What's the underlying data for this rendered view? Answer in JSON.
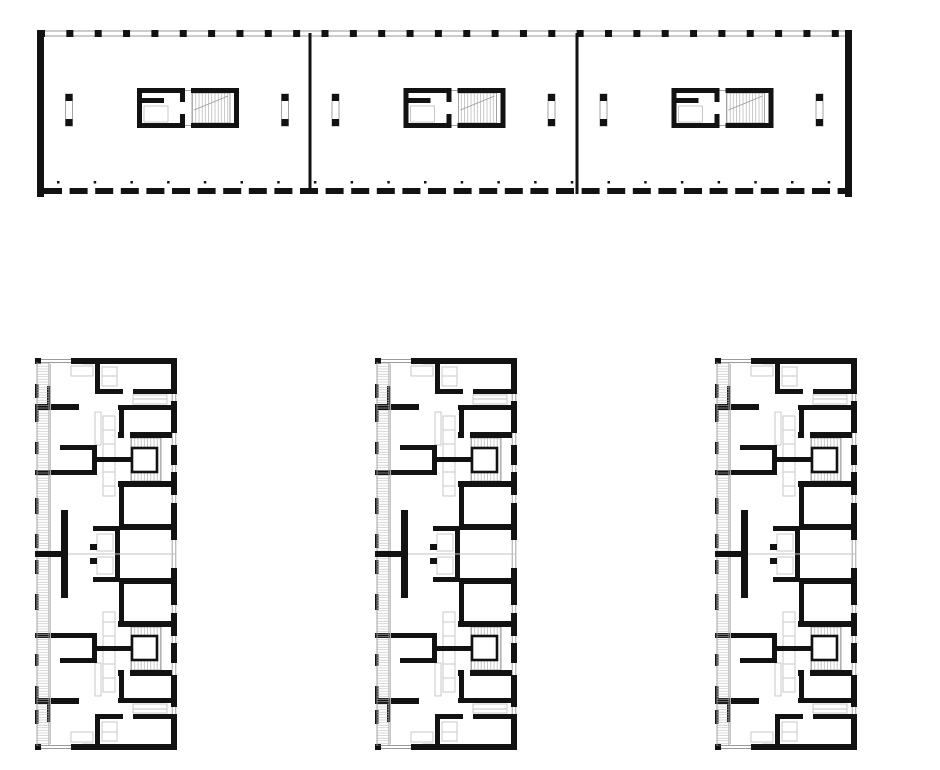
{
  "meta": {
    "description": "Black-and-white architectural floor plan drawing: one long ground-floor slab plan on top (three bays, each with an elevator and stair core and two flanking columns) and three identical tall residential floor plans below (apartments with left balcony band, stair cores with elevators, rooms with window openings).",
    "canvas_w": 940,
    "canvas_h": 770,
    "background": "#ffffff"
  },
  "colors": {
    "wall": "#121212",
    "thin": "#9a9a9a",
    "lite": "#c3c3c3",
    "hatch_h": "#bdbdbd",
    "hatch_v": "#a5a5a5",
    "paper": "#ffffff"
  },
  "figures": {
    "ground_plan": {
      "x": 0,
      "y": 0,
      "bay_centers": [
        177,
        443.5,
        711.5
      ],
      "full": [
        [
          "l",
          37,
          31,
          852,
          31,
          "thin"
        ],
        [
          "l",
          37,
          36,
          852,
          36,
          "thin"
        ],
        [
          "tk",
          38,
          30,
          29,
          28.35,
          7,
          7
        ],
        [
          "r",
          845,
          30,
          7,
          7,
          "wall"
        ],
        [
          "r",
          37,
          30,
          7,
          167,
          "wall"
        ],
        [
          "r",
          845,
          30,
          7,
          167,
          "wall"
        ],
        [
          "r",
          308.5,
          33,
          3,
          161,
          "wall"
        ],
        [
          "r",
          575.5,
          33,
          3,
          161,
          "wall"
        ],
        [
          "dl",
          44,
          188,
          801,
          18,
          7.6,
          6
        ],
        [
          "tk",
          57,
          181,
          22,
          36.7,
          2.5,
          2.5
        ]
      ],
      "bay": [
        [
          "o",
          -111.5,
          94,
          7,
          32,
          "thin"
        ],
        [
          "o",
          104.5,
          94,
          7,
          32,
          "thin"
        ],
        [
          "o",
          -33,
          106,
          24,
          16,
          "lite"
        ],
        [
          "l",
          8,
          90.5,
          14,
          90.5,
          "thin"
        ],
        [
          "l",
          8,
          125.5,
          14,
          125.5,
          "thin"
        ],
        [
          "vv",
          15,
          93,
          38,
          30
        ],
        [
          "o",
          15,
          93,
          38,
          30,
          "thin"
        ],
        [
          "l",
          17,
          110,
          51,
          96,
          "thin"
        ],
        [
          "r",
          -111.5,
          94,
          7,
          7,
          "wall"
        ],
        [
          "r",
          -111.5,
          119,
          7,
          7,
          "wall"
        ],
        [
          "r",
          104.5,
          94,
          7,
          7,
          "wall"
        ],
        [
          "r",
          104.5,
          119,
          7,
          7,
          "wall"
        ],
        [
          "r",
          -40,
          88,
          48,
          5,
          "wall"
        ],
        [
          "r",
          14,
          88,
          48,
          5,
          "wall"
        ],
        [
          "r",
          -40,
          123,
          48,
          5,
          "wall"
        ],
        [
          "r",
          14,
          123,
          48,
          5,
          "wall"
        ],
        [
          "r",
          -40,
          88,
          5,
          40,
          "wall"
        ],
        [
          "r",
          3,
          88,
          5,
          14,
          "wall"
        ],
        [
          "r",
          3,
          114,
          5,
          14,
          "wall"
        ],
        [
          "r",
          -35,
          98,
          22,
          5,
          "wall"
        ],
        [
          "r",
          57,
          88,
          5,
          40,
          "wall"
        ]
      ]
    },
    "tower_plan": {
      "y": 358,
      "w": 142,
      "h": 392,
      "half_h": 196,
      "x_positions": [
        35,
        375,
        715
      ],
      "full": [
        [
          "hh",
          2,
          4,
          12,
          384
        ],
        [
          "l",
          2,
          4,
          2,
          388,
          "thin"
        ],
        [
          "l",
          14,
          4,
          14,
          388,
          "thin"
        ],
        [
          "l",
          15.5,
          6,
          15.5,
          386,
          "lite"
        ],
        [
          "l",
          2,
          196,
          140,
          196,
          "lite"
        ],
        [
          "r",
          26,
          152,
          7,
          88,
          "wall"
        ],
        [
          "r",
          0,
          193,
          33,
          6,
          "wall"
        ]
      ],
      "half": [
        [
          "l",
          6,
          1.5,
          36,
          1.5,
          "thin"
        ],
        [
          "l",
          6,
          4.5,
          36,
          4.5,
          "thin"
        ],
        [
          "o",
          67,
          9,
          15,
          19,
          "lite"
        ],
        [
          "l",
          67,
          18,
          82,
          18,
          "lite"
        ],
        [
          "o",
          36,
          8,
          22,
          10,
          "lite"
        ],
        [
          "o",
          48,
          2,
          10,
          4,
          "lite"
        ],
        [
          "o",
          98,
          37,
          34,
          9,
          "lite"
        ],
        [
          "l",
          98,
          41,
          132,
          41,
          "lite"
        ],
        [
          "o",
          68,
          58,
          12,
          80,
          "lite"
        ],
        [
          "l",
          68,
          72,
          80,
          72,
          "lite"
        ],
        [
          "l",
          68,
          86,
          80,
          86,
          "lite"
        ],
        [
          "l",
          68,
          100,
          80,
          100,
          "lite"
        ],
        [
          "l",
          68,
          114,
          80,
          114,
          "lite"
        ],
        [
          "l",
          68,
          128,
          80,
          128,
          "lite"
        ],
        [
          "o",
          60,
          54,
          6,
          33,
          "lite"
        ],
        [
          "o",
          62,
          176,
          16,
          17,
          "lite"
        ],
        [
          "l",
          137.2,
          35,
          137.2,
          43,
          "thin"
        ],
        [
          "l",
          140.8,
          35,
          140.8,
          43,
          "thin"
        ],
        [
          "l",
          137.2,
          75,
          137.2,
          87,
          "thin"
        ],
        [
          "l",
          140.8,
          75,
          140.8,
          87,
          "thin"
        ],
        [
          "l",
          137.2,
          107,
          137.2,
          114,
          "thin"
        ],
        [
          "l",
          140.8,
          107,
          140.8,
          114,
          "thin"
        ],
        [
          "l",
          137.2,
          137,
          137.2,
          145,
          "thin"
        ],
        [
          "l",
          140.8,
          137,
          140.8,
          145,
          "thin"
        ],
        [
          "l",
          137.2,
          182,
          137.2,
          196,
          "thin"
        ],
        [
          "l",
          140.8,
          182,
          140.8,
          196,
          "thin"
        ],
        [
          "vv",
          96,
          80,
          30,
          43
        ],
        [
          "o",
          96,
          80,
          30,
          43,
          "thin"
        ],
        [
          "r",
          0,
          0,
          6,
          6,
          "wall"
        ],
        [
          "r",
          36,
          0,
          106,
          6,
          "wall"
        ],
        [
          "r",
          136,
          0,
          6,
          35,
          "wall"
        ],
        [
          "r",
          136,
          43,
          6,
          32,
          "wall"
        ],
        [
          "r",
          136,
          87,
          6,
          20,
          "wall"
        ],
        [
          "r",
          136,
          114,
          6,
          23,
          "wall"
        ],
        [
          "r",
          136,
          145,
          6,
          37,
          "wall"
        ],
        [
          "r",
          0,
          26,
          3.5,
          14,
          "wall"
        ],
        [
          "r",
          0,
          52,
          3.5,
          12,
          "wall"
        ],
        [
          "r",
          0,
          84,
          3.5,
          12,
          "wall"
        ],
        [
          "r",
          0,
          140,
          3.5,
          16,
          "wall"
        ],
        [
          "r",
          0,
          176,
          3.5,
          14,
          "wall"
        ],
        [
          "r",
          12,
          28,
          4,
          18,
          "wall"
        ],
        [
          "r",
          0,
          46,
          44,
          6,
          "wall"
        ],
        [
          "r",
          60,
          6,
          5,
          30,
          "wall"
        ],
        [
          "r",
          60,
          31,
          28,
          5,
          "wall"
        ],
        [
          "r",
          98,
          31,
          44,
          5,
          "wall"
        ],
        [
          "r",
          83,
          47,
          57,
          5,
          "wall"
        ],
        [
          "r",
          84,
          52,
          5,
          22,
          "wall"
        ],
        [
          "r",
          83,
          74,
          6,
          6,
          "wall"
        ],
        [
          "r",
          95,
          74,
          42,
          6,
          "wall"
        ],
        [
          "r",
          83,
          123,
          54,
          6,
          "wall"
        ],
        [
          "r",
          25,
          87,
          37,
          5,
          "wall"
        ],
        [
          "r",
          57,
          87,
          5,
          30,
          "wall"
        ],
        [
          "r",
          0,
          112,
          62,
          5,
          "wall"
        ],
        [
          "r",
          62,
          99,
          35,
          5,
          "wall"
        ],
        [
          "r",
          84,
          129,
          5,
          41,
          "wall"
        ],
        [
          "r",
          84,
          166,
          56,
          6,
          "wall"
        ],
        [
          "r",
          58,
          168,
          22,
          5,
          "wall"
        ],
        [
          "r",
          80,
          168,
          5,
          28,
          "wall"
        ],
        [
          "r",
          55,
          186,
          7,
          6,
          "wall"
        ],
        [
          "el",
          97,
          90,
          25,
          24
        ]
      ]
    }
  }
}
